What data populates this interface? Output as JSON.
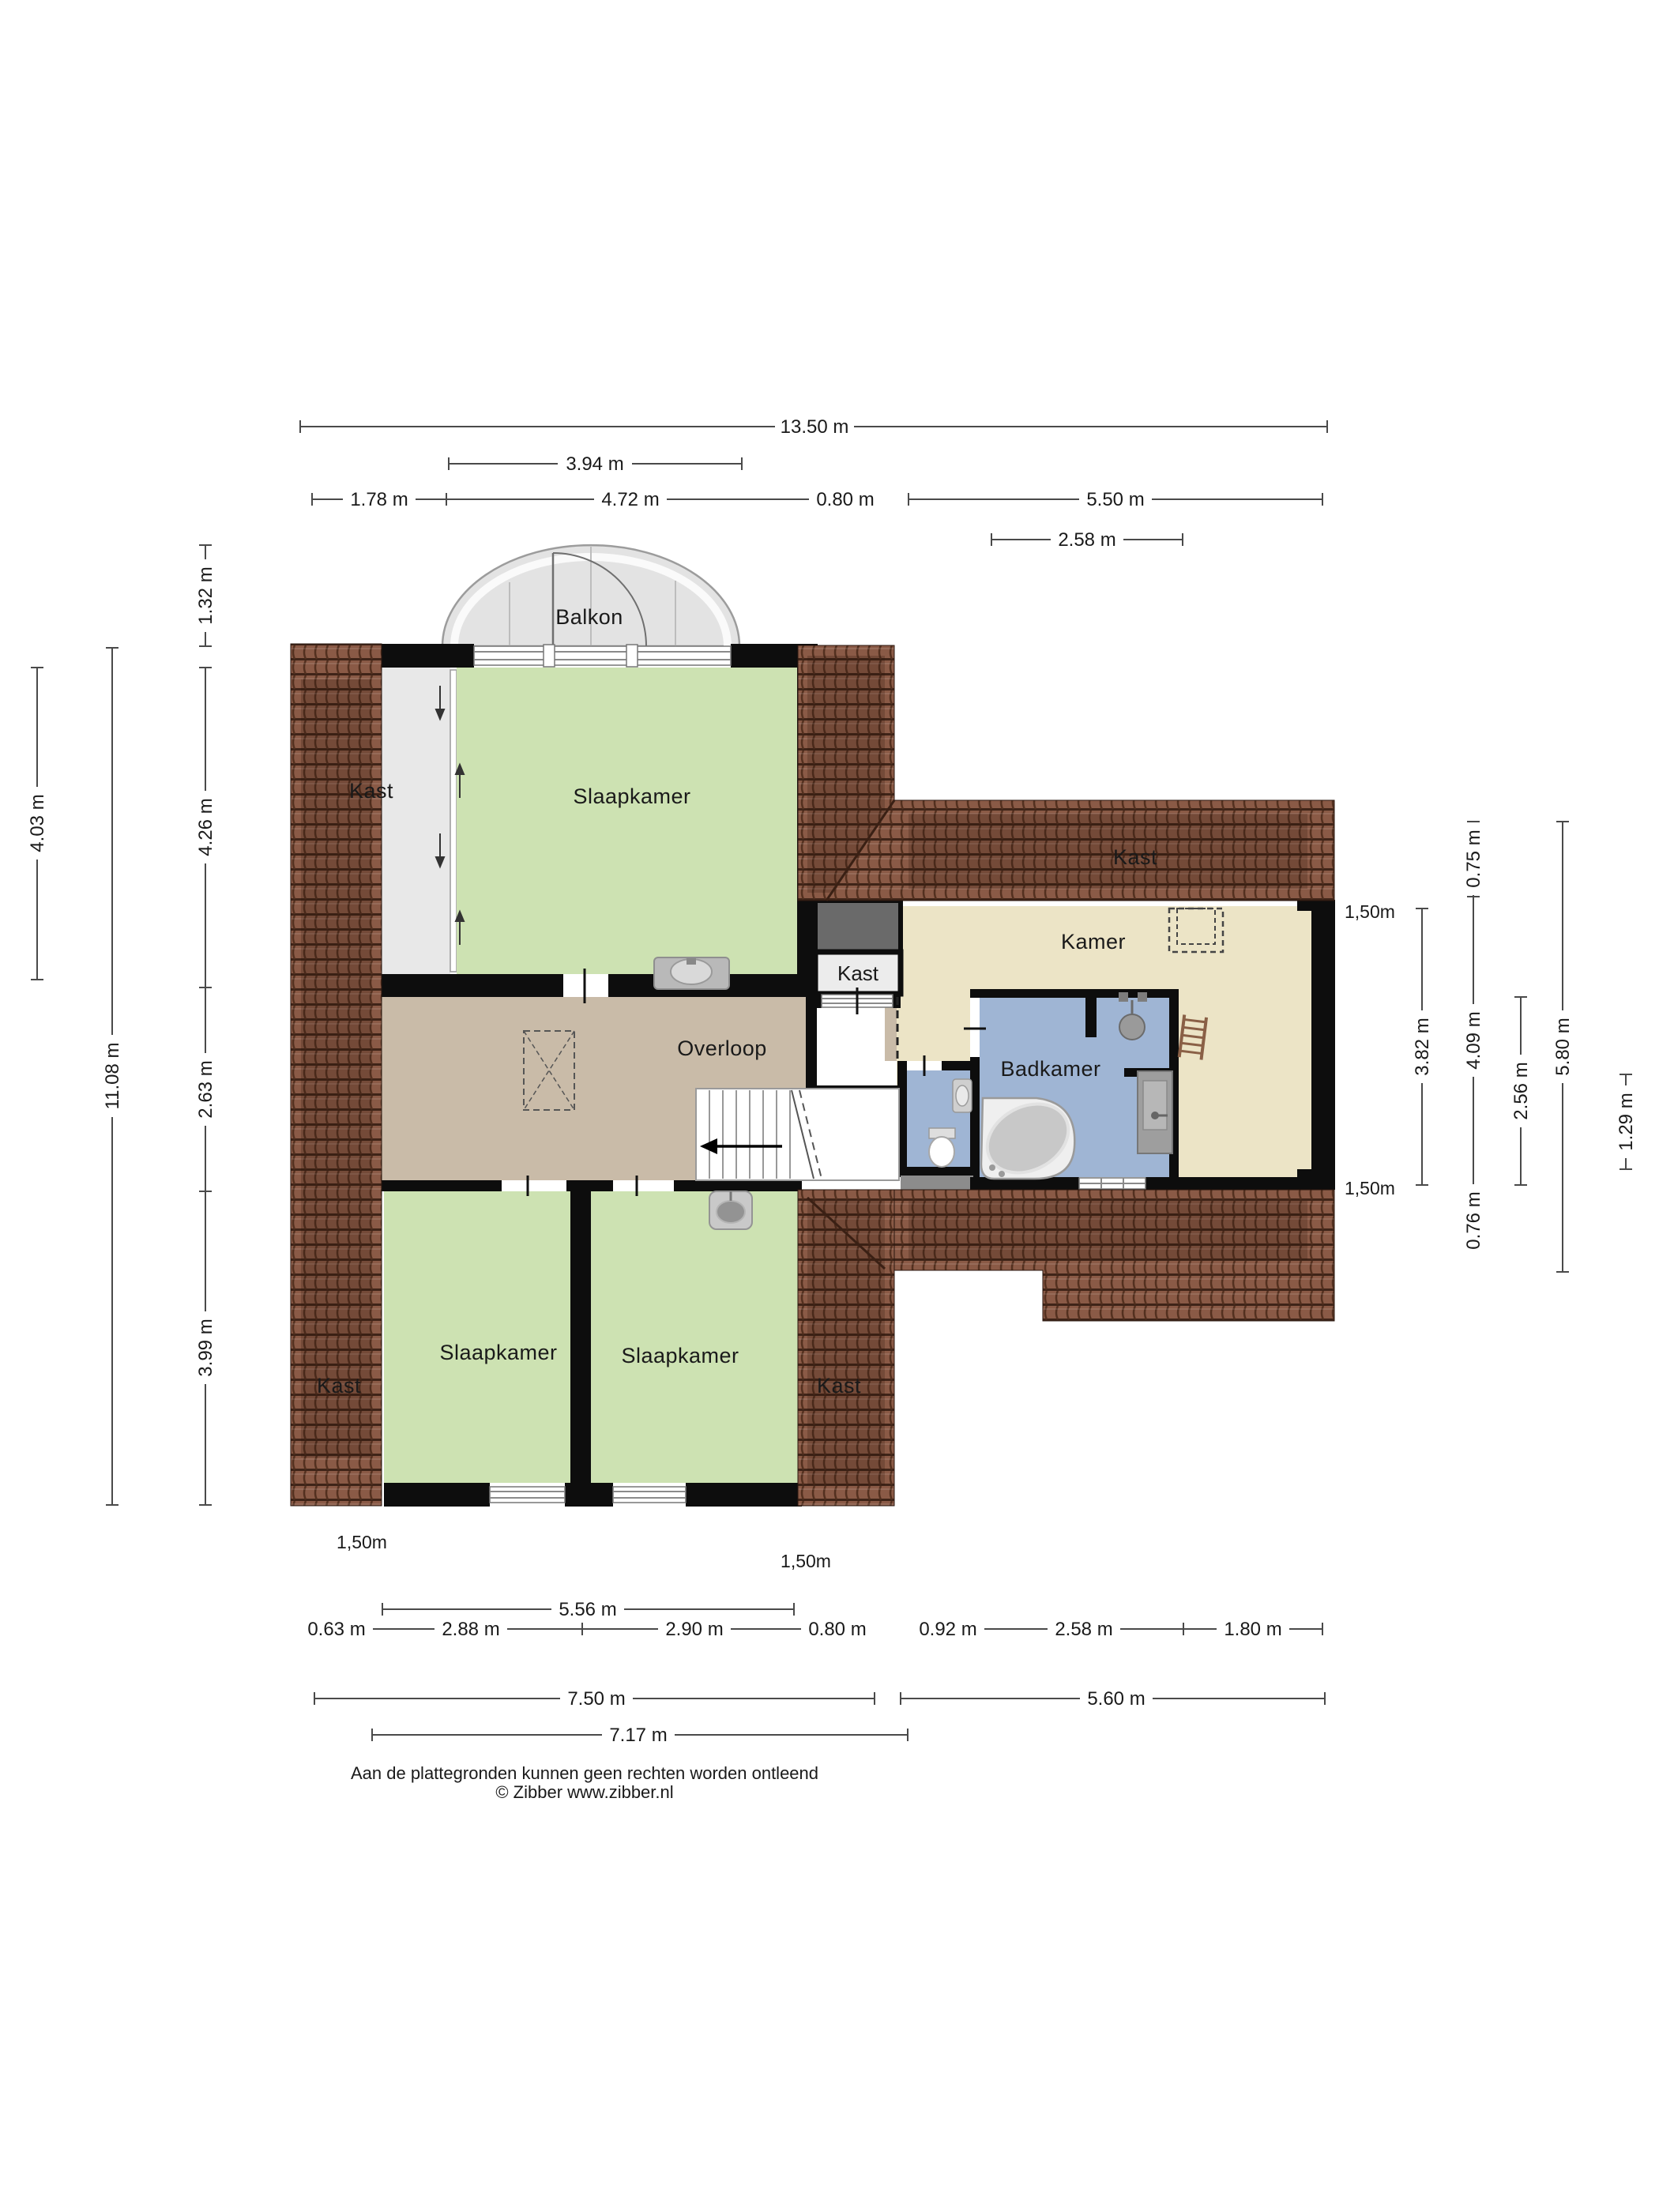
{
  "plan": {
    "rooms": {
      "balkon": "Balkon",
      "slaapkamer": "Slaapkamer",
      "overloop": "Overloop",
      "kamer": "Kamer",
      "badkamer": "Badkamer",
      "kast": "Kast"
    },
    "dims": {
      "top": {
        "total": "13.50 m",
        "balcony": "3.94 m",
        "seg_left": "1.78 m",
        "seg_mid": "4.72 m",
        "seg_strip": "0.80 m",
        "seg_right": "5.50 m",
        "kamer_width": "2.58 m"
      },
      "left": {
        "outer": "4.03 m",
        "total": "11.08 m",
        "balcony_depth": "1.32 m",
        "bedroom_depth": "4.26 m",
        "landing_depth": "2.63 m",
        "bottom_depth": "3.99 m"
      },
      "right": {
        "kamer_height": "3.82 m",
        "roof_top": "0.75 m",
        "inner": "4.09 m",
        "roof_bottom": "0.76 m",
        "bath_height": "2.56 m",
        "block_total": "5.80 m",
        "small": "1.29 m"
      },
      "bottom": {
        "rooms_width": "5.56 m",
        "s1": "0.63 m",
        "s2": "2.88 m",
        "s3": "2.90 m",
        "s4": "0.80 m",
        "s5": "0.92 m",
        "s6": "2.58 m",
        "s7": "1.80 m",
        "left_total": "7.50 m",
        "right_total": "5.60 m",
        "inner_total": "7.17 m"
      },
      "knee_height": "1,50m"
    },
    "footer": {
      "line1": "Aan de plattegronden kunnen geen rechten worden ontleend",
      "line2": "© Zibber www.zibber.nl"
    },
    "colors": {
      "roof": "#8a5a46",
      "roof_line": "#3f2418",
      "bedroom_green": "#cde2b2",
      "landing_taupe": "#c9bba8",
      "kamer_cream": "#ece4c6",
      "bath_blue": "#9fb5d4",
      "closet_gray": "#e8e8e8",
      "shaft_gray": "#6a6a6a",
      "wall_black": "#0d0d0d"
    }
  }
}
